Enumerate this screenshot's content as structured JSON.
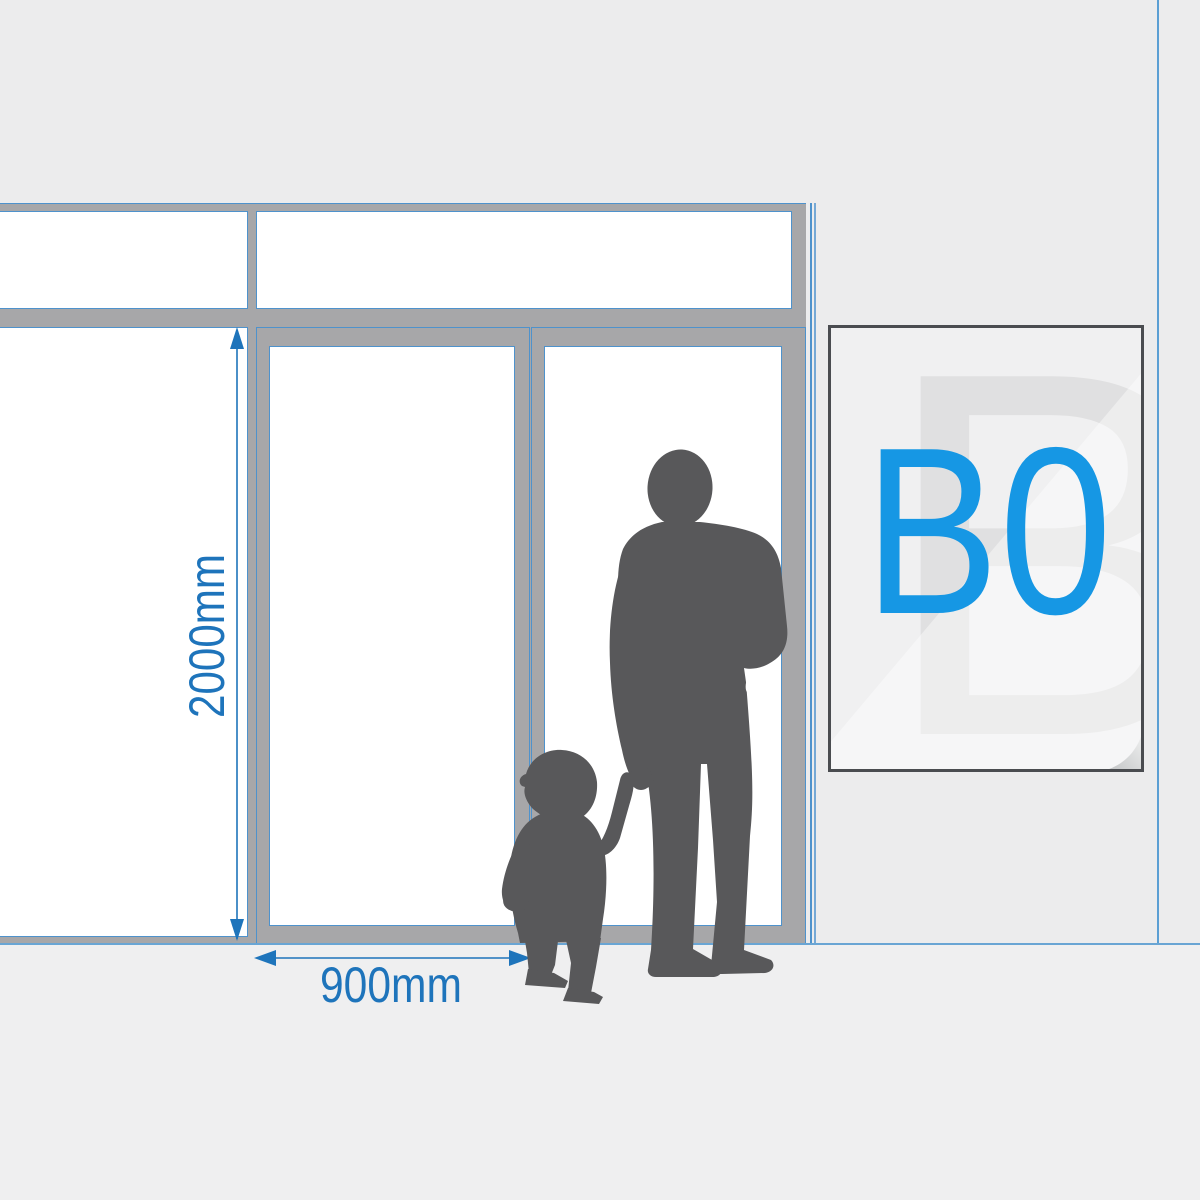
{
  "title": "B0 poster size comparison with storefront door",
  "dimensions": {
    "door_height_label": "2000mm",
    "door_width_label": "900mm"
  },
  "poster": {
    "size_label": "B0",
    "watermark_letter": "B"
  },
  "figures": {
    "adult": "adult person silhouette",
    "child": "child person silhouette"
  },
  "colors": {
    "wall": "#ececed",
    "floor": "#efeff0",
    "floor_line": "#69a5d4",
    "wall_edge_line": "#5b9fd4",
    "frame_gray": "#a7a7a9",
    "frame_outline": "#4e92cc",
    "glass": "#ffffff",
    "silhouette": "#58585a",
    "dim_blue": "#1e74bb",
    "poster_bg": "#f0f0f1",
    "poster_watermark": "#e0e0e1",
    "poster_frame": "#4a4c50",
    "poster_label": "#1697e4"
  }
}
